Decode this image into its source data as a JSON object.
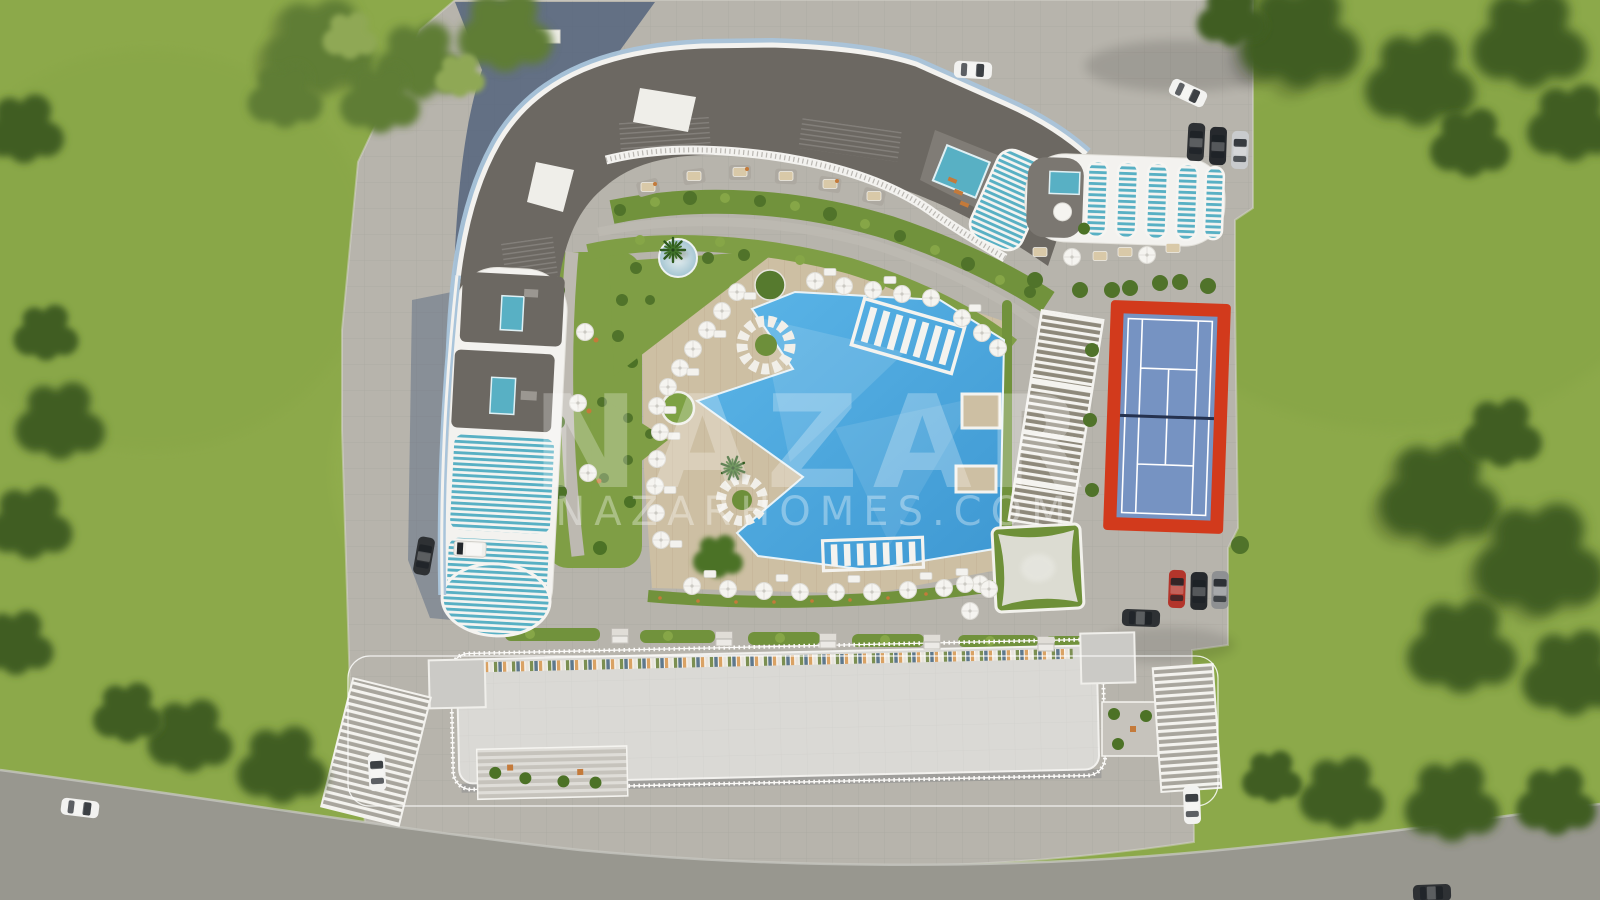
{
  "scene": {
    "kind": "aerial-3d-architectural-render",
    "subject": "bird's-eye site plan of a residential resort complex with star-shaped pool, tennis court and landscaped gardens"
  },
  "watermark": {
    "brand": "NAZAR",
    "website": "NAZARHOMES.COM"
  },
  "colors": {
    "grass": "#8CA94A",
    "grass_light": "#9CB653",
    "tree": "#3F5D24",
    "tree_light": "#5F7D36",
    "pavement": "#B7B4AC",
    "road": "#98978F",
    "shadow": "#4B5D7A",
    "roof_dark": "#6C6862",
    "building_white": "#F3F2EF",
    "glass_blue": "#A9C4DA",
    "balcony_teal": "#58B0C4",
    "deck": "#CDBFA3",
    "pool": "#4FA8DC",
    "pool_light": "#8CCAEC",
    "hedge": "#71923C",
    "garden": "#7F9E45",
    "tennis_red": "#D23A1C",
    "tennis_blue": "#7693C2",
    "net_dark": "#25324F",
    "sail": "#DCDCD2",
    "plant": "#4C7226",
    "table_orange": "#C47A3A",
    "car_white": "#F2F2F0",
    "car_red": "#B3352B",
    "car_black": "#26292D",
    "car_silver": "#C9CBCD",
    "car_gray": "#8E9092",
    "car_dark": "#2E3134"
  },
  "features": [
    {
      "name": "curved-apartment-block-north",
      "detail": "dark flat roof, white parapet, blue glass facade edge, rooftop pool terrace"
    },
    {
      "name": "striped-apartment-block-east",
      "detail": "white curved balcony rows with teal glass, rooftop pool and parasol deck"
    },
    {
      "name": "terraced-tower-west",
      "detail": "stepped terraces with two plunge pools and slatted white balconies"
    },
    {
      "name": "long-apartment-block-south",
      "detail": "light rooftop with railing, colorful balcony strip, entrance canopies and courtyards"
    },
    {
      "name": "star-shaped-swimming-pool",
      "detail": "azure pool with in-water sun shelves and deck wedges"
    },
    {
      "name": "round-lounge-ring",
      "detail": "two circular seating rings with planted centers"
    },
    {
      "name": "reflective-pond",
      "detail": "circular water feature with palm"
    },
    {
      "name": "timber-sun-deck",
      "detail": "wooden deck with umbrellas and loungers"
    },
    {
      "name": "pergola-walkway",
      "detail": "long white slatted pergola"
    },
    {
      "name": "shade-sail",
      "detail": "square stretched canopy over lawn"
    },
    {
      "name": "tennis-court",
      "detail": "blue court with white lines on red surround"
    },
    {
      "name": "parking-northeast",
      "detail": "paved lot with four cars"
    },
    {
      "name": "parking-southeast",
      "detail": "paved lot with red, black, gray cars and dark SUV"
    },
    {
      "name": "perimeter-road",
      "detail": "asphalt road along south edge"
    },
    {
      "name": "lawns-and-tree-clusters",
      "detail": "surrounding green space"
    }
  ],
  "vehicles": [
    {
      "area": "north-pavement",
      "color": "white"
    },
    {
      "area": "northeast-parking",
      "color": "white"
    },
    {
      "area": "northeast-parking",
      "color": "dark-gray"
    },
    {
      "area": "northeast-parking",
      "color": "black"
    },
    {
      "area": "northeast-parking",
      "color": "silver"
    },
    {
      "area": "southeast-parking",
      "color": "red"
    },
    {
      "area": "southeast-parking",
      "color": "black"
    },
    {
      "area": "southeast-parking",
      "color": "gray"
    },
    {
      "area": "southeast-parking",
      "color": "dark-suv"
    },
    {
      "area": "south-entrance-east",
      "color": "white"
    },
    {
      "area": "west-service-area",
      "color": "dark"
    },
    {
      "area": "west-service-area",
      "color": "white-van"
    },
    {
      "area": "road-west",
      "color": "white"
    },
    {
      "area": "road-south",
      "color": "dark"
    },
    {
      "area": "south-entrance-west",
      "color": "white"
    }
  ]
}
